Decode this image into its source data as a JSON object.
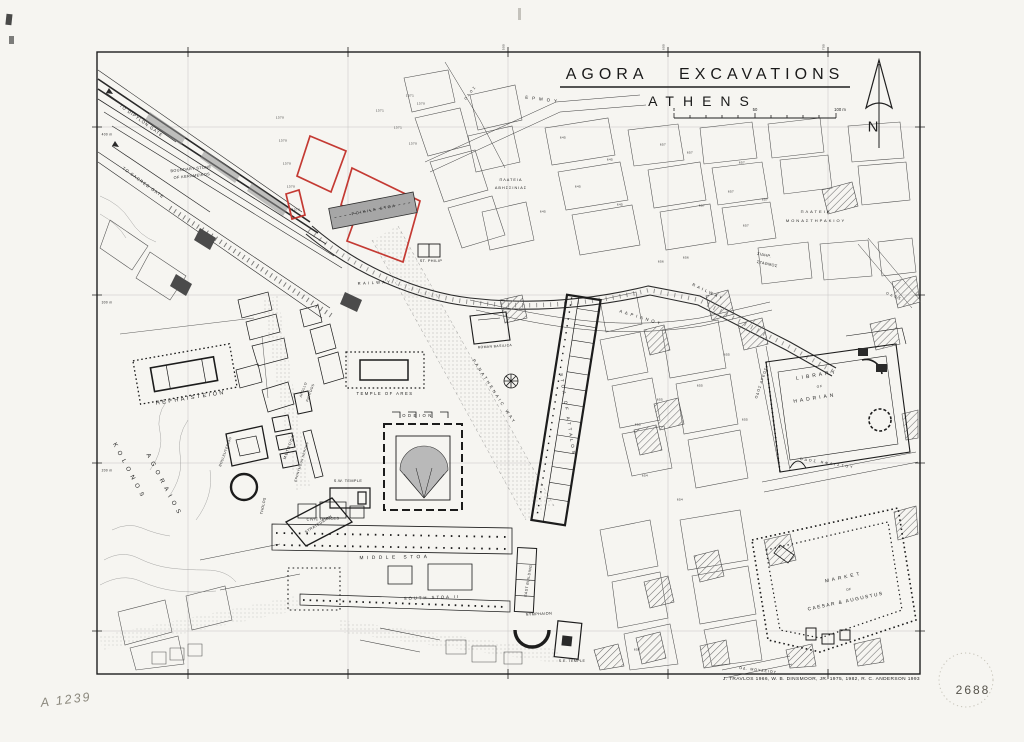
{
  "page": {
    "plate_number": "2688",
    "handwritten_id": "A 1239"
  },
  "map": {
    "title_line1": "AGORA EXCAVATIONS",
    "title_line2": "ATHENS",
    "north_label": "N",
    "credit": "J. TRAVLOS 1966,   W. B. DINSMOOR, JR. 1975, 1982,   R. C. ANDERSON 1993",
    "scale": {
      "zero": "0",
      "fifty": "50",
      "hundred": "100 m"
    },
    "colors": {
      "paper": "#f6f5f1",
      "ink": "#1f1f1f",
      "grid": "#9b9b9b",
      "excavation_outline_red": "#c43a33",
      "building_shade": "#a6a6a6"
    },
    "grid": {
      "top_labels": [
        {
          "t": "500",
          "x": 508
        },
        {
          "t": "600",
          "x": 668
        },
        {
          "t": "700",
          "x": 828
        }
      ],
      "left_labels": [
        {
          "t": "400 m",
          "y": 131
        },
        {
          "t": "300 m",
          "y": 299
        },
        {
          "t": "200 m",
          "y": 467
        }
      ]
    },
    "labels": [
      {
        "id": "to-dipylon-gate",
        "t": "TO DIPYLON GATE",
        "x": 141,
        "y": 121,
        "r": 36,
        "s": 4.2,
        "ls": 1
      },
      {
        "id": "to-sacred-gate",
        "t": "TO SACRED GATE",
        "x": 143,
        "y": 183,
        "r": 36,
        "s": 4.2,
        "ls": 1
      },
      {
        "id": "boundary-stone-line1",
        "t": "BOUNDARY STONE",
        "x": 191,
        "y": 170,
        "r": -6,
        "s": 3.8
      },
      {
        "id": "boundary-stone-line2",
        "t": "OF KERAMEIKOS",
        "x": 192,
        "y": 177,
        "r": -6,
        "s": 3.8
      },
      {
        "id": "odos-street-north",
        "t": "ΟΔΟΣ",
        "x": 471,
        "y": 93,
        "r": -52,
        "s": 3.4,
        "ls": 2
      },
      {
        "id": "ermou-street",
        "t": "ΕΡΜΟΥ",
        "x": 543,
        "y": 100,
        "r": 7,
        "s": 4.4,
        "ls": 4
      },
      {
        "id": "plateia-avissinias-line1",
        "t": "ΠΛΑΤΕΙΑ",
        "x": 511,
        "y": 181,
        "s": 3.8,
        "ls": 1
      },
      {
        "id": "plateia-avissinias-line2",
        "t": "ΑΒΗΣΣΙΝΙΑΣ",
        "x": 511,
        "y": 189,
        "s": 3.8,
        "ls": 1
      },
      {
        "id": "st-philip",
        "t": "ST. PHILIP",
        "x": 431,
        "y": 262,
        "s": 3.8
      },
      {
        "id": "plateia-monastirakiou-line1",
        "t": "ΠΛΑΤΕΙΑ",
        "x": 816,
        "y": 212,
        "s": 4,
        "ls": 2
      },
      {
        "id": "plateia-monastirakiou-line2",
        "t": "ΜΟΝΑΣΤΗΡΑΚΙΟΥ",
        "x": 816,
        "y": 221,
        "s": 4,
        "ls": 2
      },
      {
        "id": "railway-station-line1",
        "t": "ΣΙΔΗΡ.",
        "x": 764,
        "y": 256,
        "r": 12,
        "s": 3.8
      },
      {
        "id": "railway-station-line2",
        "t": "ΣΤΑΘΜΟΣ",
        "x": 767,
        "y": 265,
        "r": 12,
        "s": 3.8
      },
      {
        "id": "railway-west",
        "t": "RAILWAY",
        "x": 375,
        "y": 283,
        "r": -3,
        "s": 4,
        "ls": 2.5
      },
      {
        "id": "railway-east",
        "t": "RAILWAY",
        "x": 708,
        "y": 292,
        "r": 25,
        "s": 4,
        "ls": 2.5
      },
      {
        "id": "adrianou-street",
        "t": "ΑΔΡΙΑΝΟΥ",
        "x": 641,
        "y": 318,
        "r": 17,
        "s": 4.2,
        "ls": 3
      },
      {
        "id": "panathenaic-way",
        "t": "PANATHENAIC WAY",
        "x": 494,
        "y": 392,
        "r": 57,
        "s": 4.2,
        "ls": 2.5
      },
      {
        "id": "odos-areos",
        "t": "ΟΔΟΣ ΑΡΕΩΣ",
        "x": 762,
        "y": 383,
        "r": -72,
        "s": 3.6,
        "ls": 1
      },
      {
        "id": "odos-ifestou",
        "t": "ΟΔΟΣ ΗΦΑΙΣΤΟΥ",
        "x": 827,
        "y": 464,
        "r": 9,
        "s": 3.6,
        "ls": 2
      },
      {
        "id": "odos-street-ne",
        "t": "ΟΔΟΣ",
        "x": 894,
        "y": 297,
        "r": 22,
        "s": 3.4,
        "ls": 2
      },
      {
        "id": "od-mouseiou",
        "t": "ΟΔ. ΜΟΥΣΕΙΟΥ",
        "x": 758,
        "y": 671,
        "r": 7,
        "s": 3.6,
        "ls": 1
      },
      {
        "id": "kolonos",
        "t": "KOLONOS",
        "x": 129,
        "y": 472,
        "r": 62,
        "s": 6,
        "ls": 5
      },
      {
        "id": "agoraios",
        "t": "AGORAIOS",
        "x": 164,
        "y": 486,
        "r": 62,
        "s": 6,
        "ls": 5
      },
      {
        "id": "hephaisteion",
        "t": "HEPHAISTEION",
        "x": 191,
        "y": 399,
        "r": -9,
        "s": 5.5,
        "ls": 2.5
      },
      {
        "id": "bouleuterion",
        "t": "BOULEUTERION",
        "x": 226,
        "y": 452,
        "r": -70,
        "s": 3.4
      },
      {
        "id": "metroon",
        "t": "METROON",
        "x": 290,
        "y": 447,
        "r": -70,
        "s": 3.8,
        "ls": 1
      },
      {
        "id": "apollo-patroos-line1",
        "t": "APOLLO",
        "x": 304,
        "y": 390,
        "r": -70,
        "s": 3.4
      },
      {
        "id": "apollo-patroos-line2",
        "t": "PATROOS",
        "x": 311,
        "y": 393,
        "r": -70,
        "s": 3.4
      },
      {
        "id": "eponymous-heroes",
        "t": "EPONYMOUS HEROES",
        "x": 302,
        "y": 462,
        "r": -73,
        "s": 3.2
      },
      {
        "id": "tholos",
        "t": "THOLOS",
        "x": 264,
        "y": 506,
        "r": -78,
        "s": 3.6
      },
      {
        "id": "strategeion",
        "t": "STRATEGEION",
        "x": 319,
        "y": 525,
        "r": -32,
        "s": 3.8
      },
      {
        "id": "poikile-stoa",
        "t": "POIKILE STOA",
        "x": 374,
        "y": 210,
        "r": -11,
        "s": 4,
        "ls": 1.5
      },
      {
        "id": "roman-basilica",
        "t": "ROMAN BASILICA",
        "x": 495,
        "y": 347,
        "r": -4,
        "s": 3.4
      },
      {
        "id": "temple-of-ares",
        "t": "TEMPLE OF ARES",
        "x": 385,
        "y": 394,
        "s": 4.2,
        "ls": 1.5
      },
      {
        "id": "odeion",
        "t": "ODEION",
        "x": 418,
        "y": 416,
        "s": 4.2,
        "ls": 2.5
      },
      {
        "id": "sw-temple",
        "t": "S.W. TEMPLE",
        "x": 348,
        "y": 482,
        "s": 3.8
      },
      {
        "id": "civic-offices",
        "t": "CIVIC OFFICES",
        "x": 323,
        "y": 520,
        "r": -2,
        "s": 3.8
      },
      {
        "id": "middle-stoa",
        "t": "MIDDLE STOA",
        "x": 395,
        "y": 559,
        "r": -1,
        "s": 4.8,
        "ls": 3.5
      },
      {
        "id": "south-stoa-ii",
        "t": "SOUTH STOA II",
        "x": 432,
        "y": 598,
        "r": -2,
        "s": 4.2,
        "ls": 2
      },
      {
        "id": "east-building",
        "t": "EAST BUILDING",
        "x": 529,
        "y": 581,
        "r": -80,
        "s": 3.6
      },
      {
        "id": "nymphaion",
        "t": "NYMPHAION",
        "x": 539,
        "y": 615,
        "r": -3,
        "s": 3.8
      },
      {
        "id": "se-temple",
        "t": "S.E. TEMPLE",
        "x": 572,
        "y": 662,
        "s": 3.6
      },
      {
        "id": "stoa-of-attalos",
        "t": "STOA OF ATTALOS",
        "x": 567,
        "y": 415,
        "r": 81,
        "s": 4.4,
        "ls": 3
      },
      {
        "id": "library-of-hadrian-line1",
        "t": "LIBRARY",
        "x": 817,
        "y": 376,
        "r": -9,
        "s": 5,
        "ls": 3
      },
      {
        "id": "library-of-hadrian-line2",
        "t": "OF",
        "x": 820,
        "y": 387,
        "r": -9,
        "s": 3.2,
        "ls": 1
      },
      {
        "id": "library-of-hadrian-line3",
        "t": "HADRIAN",
        "x": 815,
        "y": 399,
        "r": -9,
        "s": 5,
        "ls": 3
      },
      {
        "id": "market-caesar-line1",
        "t": "MARKET",
        "x": 844,
        "y": 579,
        "r": -12,
        "s": 4.8,
        "ls": 3
      },
      {
        "id": "market-caesar-line2",
        "t": "OF",
        "x": 849,
        "y": 590,
        "r": -12,
        "s": 3.2
      },
      {
        "id": "market-caesar-line3",
        "t": "CAESAR & AUGUSTUS",
        "x": 846,
        "y": 603,
        "r": -12,
        "s": 4.8,
        "ls": 1.5
      }
    ],
    "parcels": [
      {
        "t": "1371",
        "x": 410,
        "y": 96
      },
      {
        "t": "1370",
        "x": 421,
        "y": 104
      },
      {
        "t": "1370",
        "x": 280,
        "y": 118
      },
      {
        "t": "1370",
        "x": 283,
        "y": 141
      },
      {
        "t": "1370",
        "x": 287,
        "y": 164
      },
      {
        "t": "1370",
        "x": 291,
        "y": 187
      },
      {
        "t": "1370",
        "x": 296,
        "y": 210
      },
      {
        "t": "1371",
        "x": 380,
        "y": 111
      },
      {
        "t": "1371",
        "x": 398,
        "y": 128
      },
      {
        "t": "1370",
        "x": 413,
        "y": 144
      },
      {
        "t": "645",
        "x": 563,
        "y": 138
      },
      {
        "t": "645",
        "x": 610,
        "y": 160
      },
      {
        "t": "645",
        "x": 578,
        "y": 187
      },
      {
        "t": "645",
        "x": 543,
        "y": 212
      },
      {
        "t": "645",
        "x": 620,
        "y": 205
      },
      {
        "t": "657",
        "x": 663,
        "y": 145
      },
      {
        "t": "657",
        "x": 690,
        "y": 153
      },
      {
        "t": "657",
        "x": 742,
        "y": 163
      },
      {
        "t": "657",
        "x": 731,
        "y": 192
      },
      {
        "t": "657",
        "x": 702,
        "y": 206
      },
      {
        "t": "657",
        "x": 765,
        "y": 200
      },
      {
        "t": "657",
        "x": 746,
        "y": 226
      },
      {
        "t": "656",
        "x": 661,
        "y": 262
      },
      {
        "t": "656",
        "x": 686,
        "y": 258
      },
      {
        "t": "655",
        "x": 638,
        "y": 425
      },
      {
        "t": "655",
        "x": 727,
        "y": 355
      },
      {
        "t": "655",
        "x": 700,
        "y": 386
      },
      {
        "t": "655",
        "x": 660,
        "y": 400
      },
      {
        "t": "655",
        "x": 745,
        "y": 420
      },
      {
        "t": "654",
        "x": 645,
        "y": 476
      },
      {
        "t": "654",
        "x": 680,
        "y": 500
      },
      {
        "t": "658",
        "x": 637,
        "y": 650
      }
    ]
  }
}
